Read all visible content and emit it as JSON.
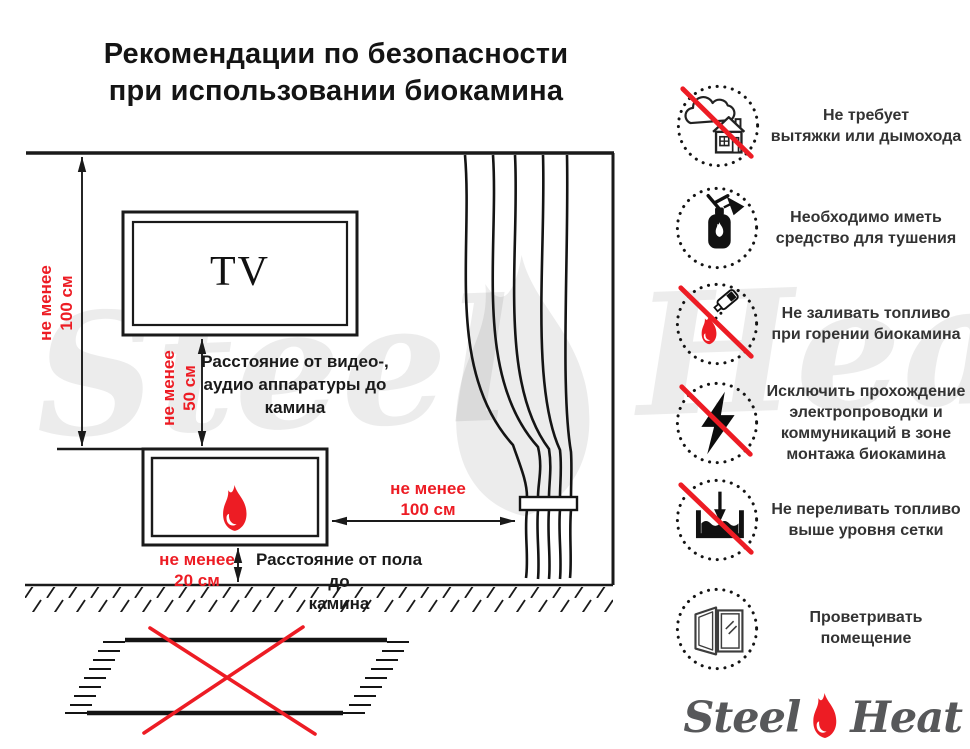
{
  "title": {
    "line1": "Рекомендации по безопасности",
    "line2": "при использовании биокамина"
  },
  "colors": {
    "red": "#ed1c24",
    "line": "#1a1a1a",
    "logo_gray": "#57585a"
  },
  "diagram": {
    "tv_label": "TV",
    "wall_distance": {
      "line1": "не менее",
      "line2": "100 см"
    },
    "tv_distance": {
      "line1": "не менее",
      "line2": "50 см"
    },
    "curtain_distance": {
      "line1": "не менее",
      "line2": "100 см"
    },
    "floor_distance": {
      "line1": "не менее",
      "line2": "20 см"
    },
    "tv_caption": {
      "line1": "Расстояние от видео-,",
      "line2": "аудио аппаратуры до",
      "line3": "камина"
    },
    "floor_caption": {
      "line1": "Расстояние от пола до",
      "line2": "камина"
    }
  },
  "rules": [
    {
      "icon": "no-chimney-icon",
      "prohibited": true,
      "lines": [
        "Не требует",
        "вытяжки или дымохода"
      ]
    },
    {
      "icon": "fire-extinguisher-icon",
      "prohibited": false,
      "lines": [
        "Необходимо иметь",
        "средство для тушения"
      ]
    },
    {
      "icon": "no-refuel-burning-icon",
      "prohibited": true,
      "lines": [
        "Не заливать топливо",
        "при горении биокамина"
      ]
    },
    {
      "icon": "no-wiring-icon",
      "prohibited": true,
      "lines": [
        "Исключить прохождение",
        "электропроводки и",
        "коммуникаций в зоне",
        "монтажа биокамина"
      ]
    },
    {
      "icon": "no-overfill-icon",
      "prohibited": true,
      "lines": [
        "Не переливать топливо",
        "выше уровня сетки"
      ]
    },
    {
      "icon": "ventilate-icon",
      "prohibited": false,
      "lines": [
        "Проветривать",
        "помещение"
      ]
    }
  ],
  "watermark": {
    "left": "Steel",
    "right": "Heat"
  },
  "logo": {
    "left": "Steel",
    "right": "Heat"
  }
}
